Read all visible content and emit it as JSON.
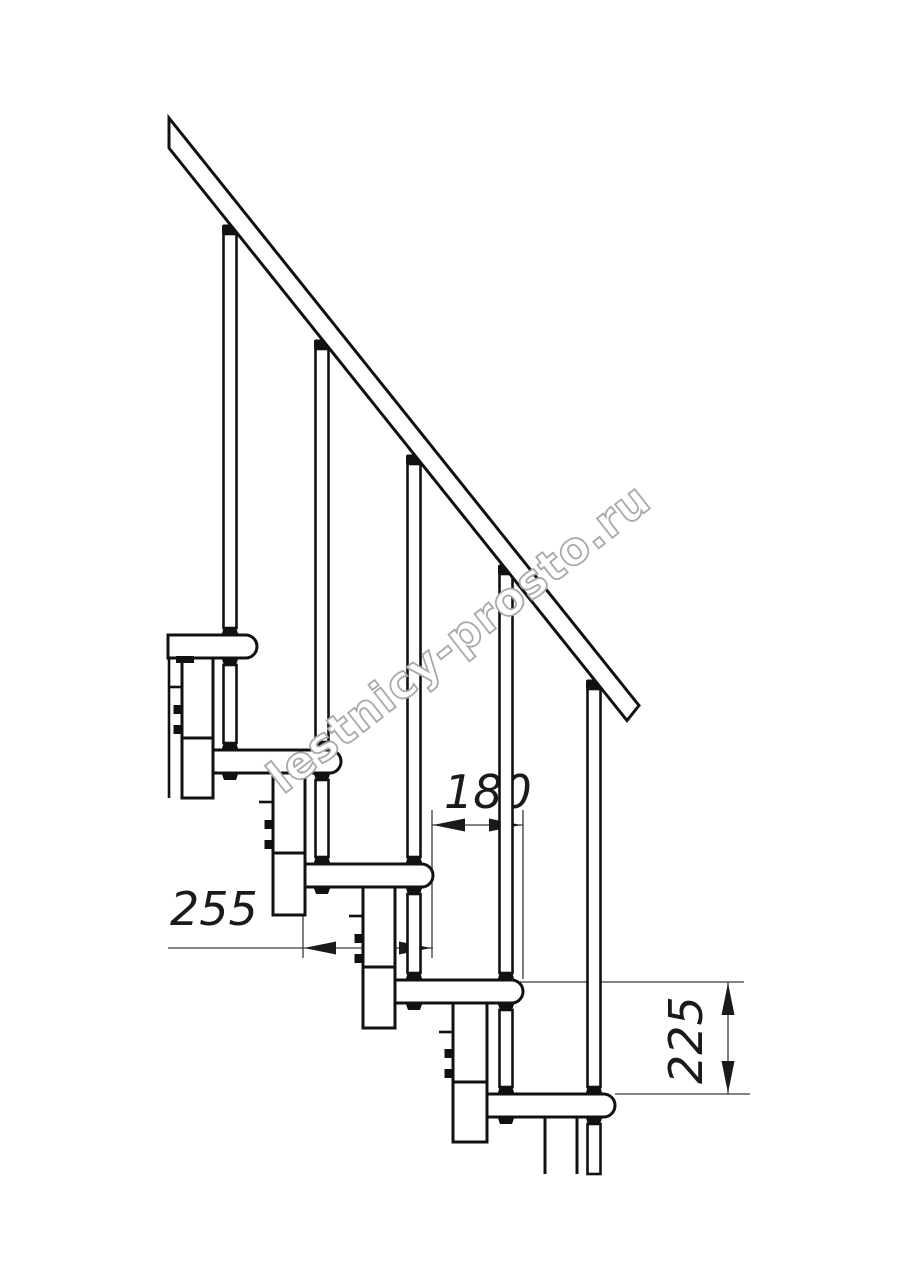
{
  "drawing": {
    "type": "staircase-side-elevation",
    "watermark": {
      "text": "lestnicy-prosto.ru"
    },
    "dimensions": {
      "step_run": "180",
      "tread_depth": "255",
      "step_rise": "225"
    },
    "colors": {
      "line": "#111111",
      "dimension_line": "#3a3a3a",
      "watermark_stroke": "#a9a9a9",
      "background": "#ffffff"
    }
  }
}
